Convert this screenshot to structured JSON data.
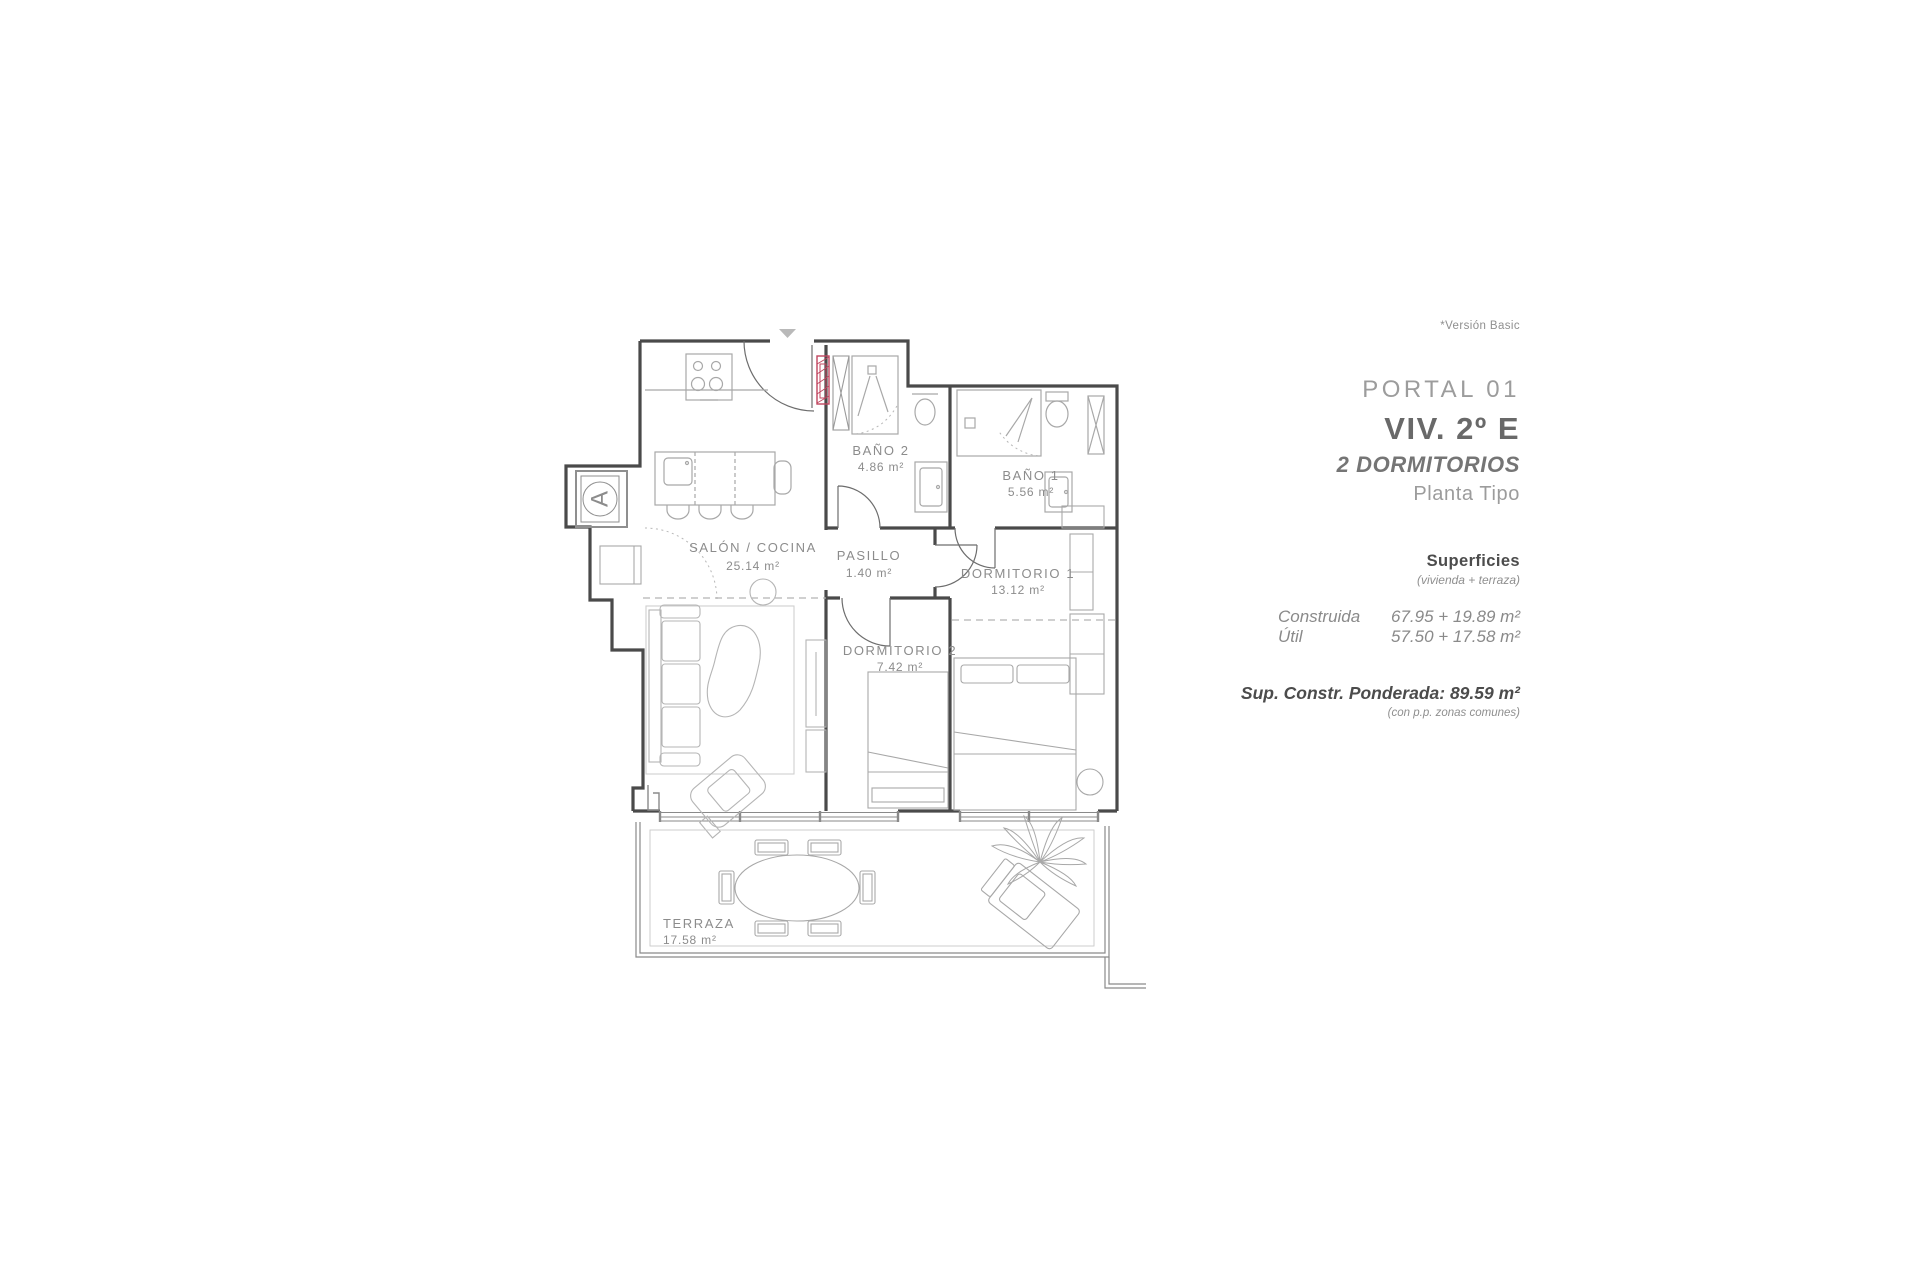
{
  "annotation": {
    "version_note": "*Versión Basic"
  },
  "header": {
    "portal": "PORTAL 01",
    "unit": "VIV. 2º E",
    "type": "2 DORMITORIOS",
    "floor": "Planta Tipo"
  },
  "surfaces": {
    "title": "Superficies",
    "subtitle": "(vivienda + terraza)",
    "rows": [
      {
        "label": "Construida",
        "value": "67.95 + 19.89 m²"
      },
      {
        "label": "Útil",
        "value": "57.50 + 17.58 m²"
      }
    ],
    "weighted": "Sup. Constr. Ponderada: 89.59 m²",
    "weighted_note": "(con p.p. zonas comunes)"
  },
  "plan": {
    "elevator_label": "A",
    "rooms": [
      {
        "name": "SALÓN / COCINA",
        "area": "25.14 m²"
      },
      {
        "name": "PASILLO",
        "area": "1.40 m²"
      },
      {
        "name": "BAÑO 2",
        "area": "4.86 m²"
      },
      {
        "name": "BAÑO 1",
        "area": "5.56 m²"
      },
      {
        "name": "DORMITORIO 1",
        "area": "13.12 m²"
      },
      {
        "name": "DORMITORIO 2",
        "area": "7.42 m²"
      },
      {
        "name": "TERRAZA",
        "area": "17.58 m²"
      }
    ]
  },
  "colors": {
    "wall": "#4a4a4a",
    "fixture": "#a8a8a8",
    "label": "#8c8c8c",
    "accent": "#c0455e",
    "marker": "#b9b9b9"
  }
}
